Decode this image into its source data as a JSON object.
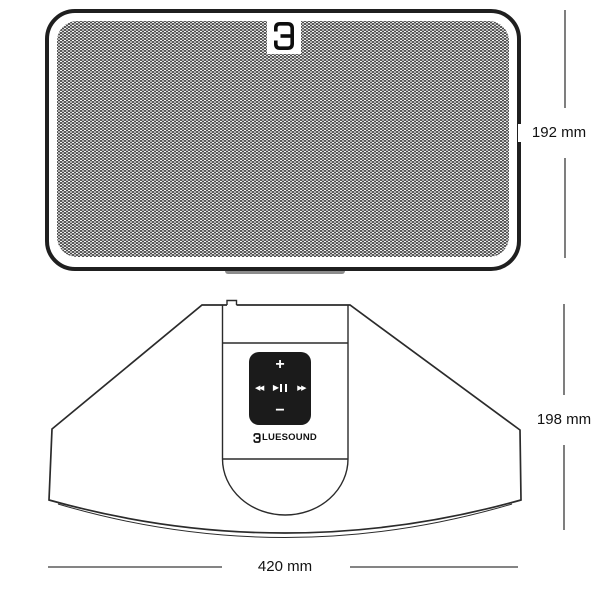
{
  "product": {
    "brand_wordmark": "BLUESOUND",
    "brand_wordmark_rest": "LUESOUND"
  },
  "dimensions": {
    "front_height": "192 mm",
    "top_depth": "198 mm",
    "width": "420 mm"
  },
  "controls": {
    "volume_up_label": "+",
    "volume_down_label": "−",
    "skip_back_icon": "◀◀",
    "play_icon": "▶",
    "skip_forward_icon": "▶▶"
  },
  "colors": {
    "line": "#2b2b2b",
    "line_strong": "#1f1f1f",
    "pad_bg": "#1b1b1b",
    "pad_fg": "#ffffff",
    "text": "#111111",
    "grille_dot": "#4a4a4a",
    "grille_bg": "#f4f4f4",
    "foot": "#8c8c8c",
    "background": "#ffffff"
  }
}
